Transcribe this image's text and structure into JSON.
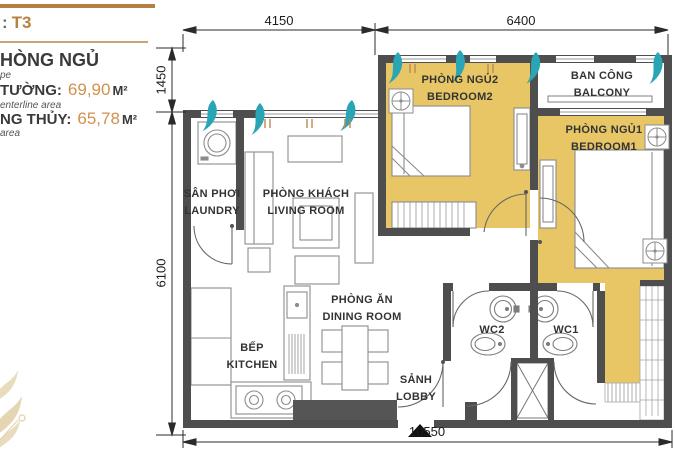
{
  "panel": {
    "title_prefix": ":",
    "title_value": "T3",
    "heading": "HÒNG NGỦ",
    "heading_note": "pe",
    "metrics": [
      {
        "label": "TƯỜNG:",
        "value": "69,90",
        "unit": "M²",
        "note": "enterline area"
      },
      {
        "label": "NG THỦY:",
        "value": "65,78",
        "unit": "M²",
        "note": "area"
      }
    ]
  },
  "plan": {
    "dimensions": {
      "top_left": "4150",
      "top_right": "6400",
      "left_upper": "1450",
      "left_lower": "6100",
      "bottom": "10550"
    },
    "rooms": {
      "laundry": {
        "vi": "SÂN PHƠI",
        "en": "LAUNDRY"
      },
      "living": {
        "vi": "PHÒNG KHÁCH",
        "en": "LIVING ROOM"
      },
      "bedroom2": {
        "vi": "PHÒNG NGỦ2",
        "en": "BEDROOM2"
      },
      "balcony": {
        "vi": "BAN CÔNG",
        "en": "BALCONY"
      },
      "bedroom1": {
        "vi": "PHÒNG NGỦ1",
        "en": "BEDROOM1"
      },
      "kitchen": {
        "vi": "BẾP",
        "en": "KITCHEN"
      },
      "dining": {
        "vi": "PHÒNG ĂN",
        "en": "DINING ROOM"
      },
      "wc2": {
        "label": "WC2"
      },
      "wc1": {
        "label": "WC1"
      },
      "lobby": {
        "vi": "SẢNH",
        "en": "LOBBY"
      }
    },
    "colors": {
      "room_fill": "#e8c666",
      "wall": "#4e4e4e",
      "curtain_teal": "#2aa5b5",
      "accent_tan": "#b5823f"
    }
  }
}
